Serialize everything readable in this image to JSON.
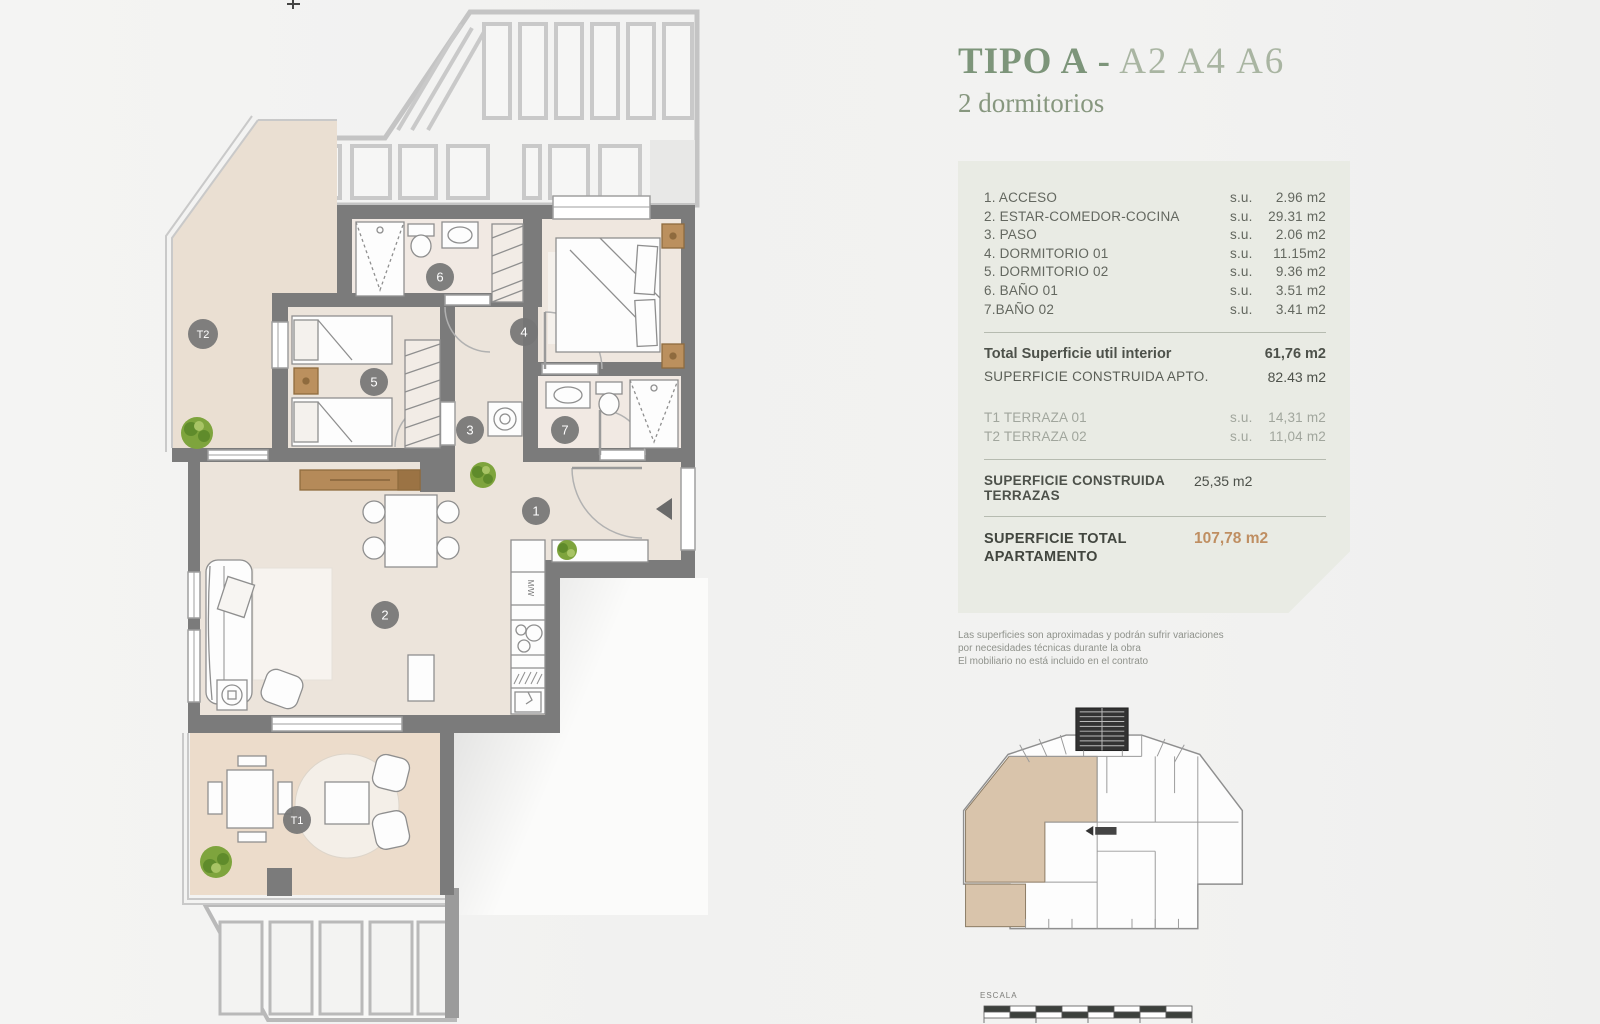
{
  "header": {
    "type_label": "TIPO A",
    "separator": " - ",
    "units": "A2 A4 A6",
    "subtitle": "2 dormitorios"
  },
  "areas": {
    "rooms": [
      {
        "name": "1. ACCESO",
        "unit": "s.u.",
        "value": "2.96 m2"
      },
      {
        "name": "2. ESTAR-COMEDOR-COCINA",
        "unit": "s.u.",
        "value": "29.31 m2"
      },
      {
        "name": "3. PASO",
        "unit": "s.u.",
        "value": "2.06 m2"
      },
      {
        "name": "4. DORMITORIO 01",
        "unit": "s.u.",
        "value": "11.15m2"
      },
      {
        "name": "5. DORMITORIO 02",
        "unit": "s.u.",
        "value": "9.36 m2"
      },
      {
        "name": "6. BAÑO 01",
        "unit": "s.u.",
        "value": "3.51 m2"
      },
      {
        "name": "7.BAÑO 02",
        "unit": "s.u.",
        "value": "3.41 m2"
      }
    ],
    "total_util": {
      "label": "Total Superficie util interior",
      "value": "61,76 m2"
    },
    "constructed": {
      "label": "SUPERFICIE CONSTRUIDA APTO.",
      "value": "82.43 m2"
    },
    "terraces": [
      {
        "name": "T1 TERRAZA 01",
        "unit": "s.u.",
        "value": "14,31 m2"
      },
      {
        "name": "T2 TERRAZA 02",
        "unit": "s.u.",
        "value": "11,04 m2"
      }
    ],
    "terraces_constructed": {
      "label": "SUPERFICIE CONSTRUIDA TERRAZAS",
      "value": "25,35 m2"
    },
    "total": {
      "label": "SUPERFICIE TOTAL APARTAMENTO",
      "value": "107,78 m2"
    }
  },
  "disclaimer": [
    "Las superficies son aproximadas y podrán sufrir variaciones",
    "por necesidades técnicas durante la obra",
    "El mobiliario no está incluido en el contrato"
  ],
  "plan": {
    "badges": [
      {
        "label": "1"
      },
      {
        "label": "2"
      },
      {
        "label": "3"
      },
      {
        "label": "4"
      },
      {
        "label": "5"
      },
      {
        "label": "6"
      },
      {
        "label": "7"
      },
      {
        "label": "T1"
      },
      {
        "label": "T2"
      }
    ],
    "kitchen_label": "M/W"
  },
  "scale": {
    "label": "ESCALA",
    "ticks": [
      "0",
      "1",
      "2",
      "3",
      "4"
    ],
    "scale_text": "E: 1/10",
    "edition_text": "ED.1.0 - marzo 2025",
    "units_text": "metros"
  },
  "colors": {
    "title_green": "#7d957a",
    "units_green": "#a9b5a2",
    "card_background": "#e9ebe4",
    "accent_tan": "#bf8e61",
    "wall_gray": "#7b7b7b",
    "floor_beige": "#ece4db",
    "terrace_beige": "#ecdccb",
    "plant_green": "#7ea43d"
  }
}
